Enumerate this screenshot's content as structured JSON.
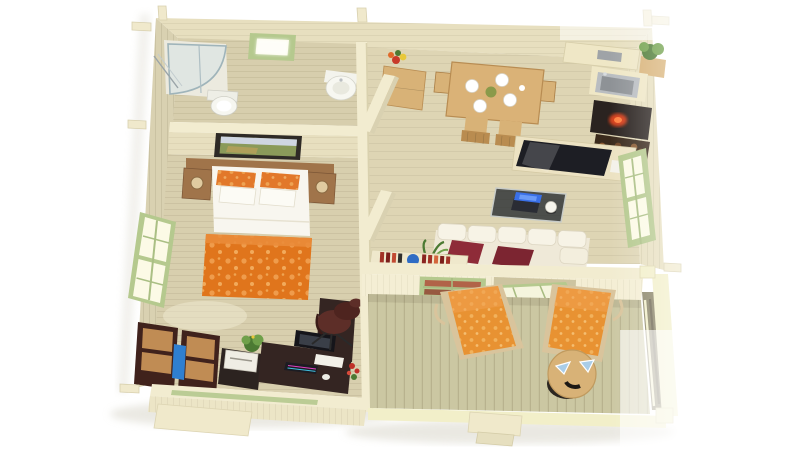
{
  "scene": {
    "description": "3D rendered top-down floor plan of a one-bedroom wooden cabin with terrace",
    "background": "#ffffff",
    "rooms": [
      {
        "name": "bathroom",
        "items": [
          "shower",
          "toilet",
          "corner-sink",
          "skylight"
        ]
      },
      {
        "name": "bedroom",
        "items": [
          "double-bed",
          "orange-duvet",
          "nightstands",
          "lamps",
          "wall-painting",
          "window"
        ]
      },
      {
        "name": "home-office",
        "items": [
          "corner-desk",
          "monitor",
          "keyboard",
          "office-chair",
          "cabinets",
          "printer",
          "plant",
          "flowers"
        ]
      },
      {
        "name": "kitchen-dining",
        "items": [
          "dining-table",
          "four-chairs",
          "sink",
          "stove",
          "firewood",
          "shelf",
          "corner-plant"
        ]
      },
      {
        "name": "living-room",
        "items": [
          "tv-sideboard",
          "tv",
          "coffee-table",
          "laptop",
          "sofa",
          "red-pillows",
          "book-sideboard",
          "palm-plant"
        ]
      },
      {
        "name": "hallway",
        "items": [
          "cabinet",
          "flower-vase",
          "partition-half-walls"
        ]
      },
      {
        "name": "terrace",
        "items": [
          "lounger-left",
          "lounger-right",
          "round-table",
          "railing",
          "steps",
          "terrace-door",
          "shuttered-window"
        ]
      }
    ]
  },
  "colors": {
    "wallTop": "#f2ecd0",
    "wallFace": "#e7dfbf",
    "wallFaceDark": "#d9d1b1",
    "floorBath": "#d7cead",
    "floorBed": "#d8cfae",
    "floorLiv": "#ded5b4",
    "floorTerr": "#cbc7a2",
    "green": "#b5c98e",
    "greenDeep": "#9ab873",
    "glass": "#fcfae6",
    "woodMid": "#a0744a",
    "woodLight": "#d8b277",
    "tableWood": "#dab277",
    "orange": "#e2782a",
    "orangeLight": "#f0a050",
    "duvet": "#e0751c",
    "lounger": "#e89232",
    "white": "#f8f6ef",
    "espresso": "#342522",
    "cabDark": "#40221c",
    "drawer": "#c08c54",
    "chairRed": "#5d2e28",
    "sofa": "#efe9d8",
    "pillow": "#8e2b38",
    "tv": "#1d1e24",
    "steel": "#b9bdc1",
    "stove": "#2a2320",
    "ember": "#e8441c",
    "plant": "#4c7a33",
    "plantLight": "#6fa04a",
    "laptop": "#3a70e8",
    "bookRed": "#a23226",
    "bookBlue": "#2f6cc4",
    "binBlue": "#2f7fd0",
    "terrRail": "#f2efc9",
    "frameDark": "#2e2a26",
    "shadow": "#d6d3c6"
  }
}
